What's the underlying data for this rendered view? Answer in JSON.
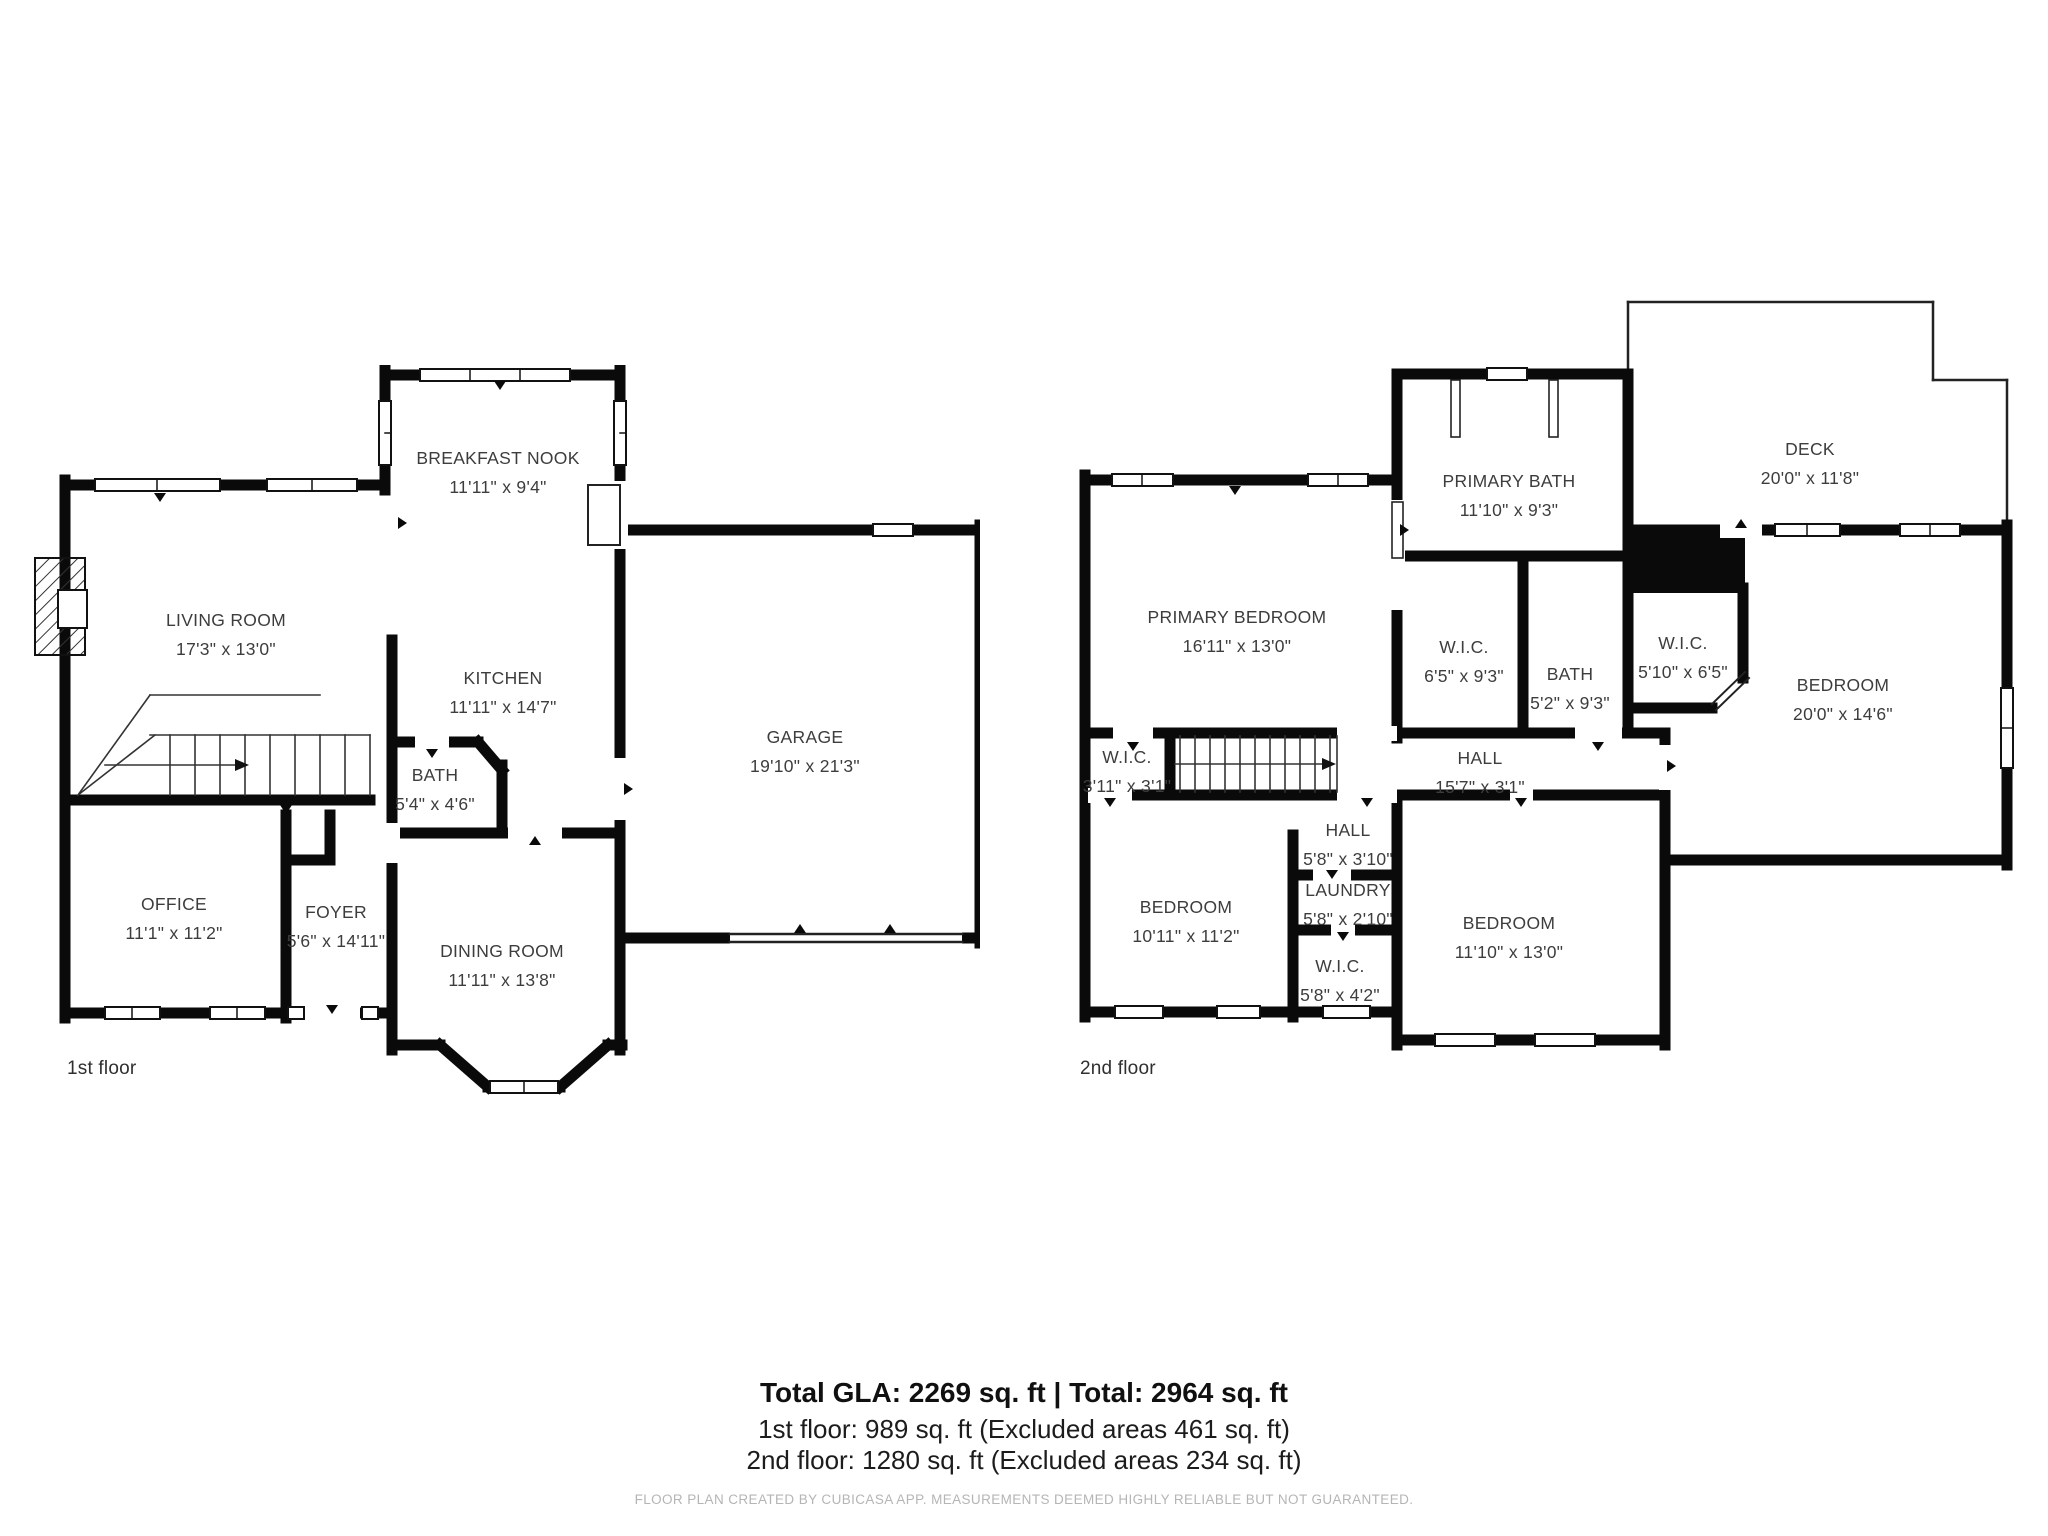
{
  "page": {
    "background": "#ffffff",
    "wall_color": "#0a0a0a",
    "label_color": "#3d3d3d",
    "footer_color": "#b5b5b5"
  },
  "floor1": {
    "caption": "1st floor",
    "rooms": {
      "breakfast_nook": {
        "name": "BREAKFAST NOOK",
        "dims": "11'11\" x 9'4\""
      },
      "living_room": {
        "name": "LIVING ROOM",
        "dims": "17'3\" x 13'0\""
      },
      "kitchen": {
        "name": "KITCHEN",
        "dims": "11'11\" x 14'7\""
      },
      "garage": {
        "name": "GARAGE",
        "dims": "19'10\" x 21'3\""
      },
      "bath": {
        "name": "BATH",
        "dims": "5'4\" x 4'6\""
      },
      "office": {
        "name": "OFFICE",
        "dims": "11'1\" x 11'2\""
      },
      "foyer": {
        "name": "FOYER",
        "dims": "5'6\" x 14'11\""
      },
      "dining_room": {
        "name": "DINING ROOM",
        "dims": "11'11\" x 13'8\""
      }
    }
  },
  "floor2": {
    "caption": "2nd floor",
    "rooms": {
      "primary_bath": {
        "name": "PRIMARY BATH",
        "dims": "11'10\" x 9'3\""
      },
      "deck": {
        "name": "DECK",
        "dims": "20'0\" x 11'8\""
      },
      "primary_bedroom": {
        "name": "PRIMARY BEDROOM",
        "dims": "16'11\" x 13'0\""
      },
      "wic_primary": {
        "name": "W.I.C.",
        "dims": "6'5\" x 9'3\""
      },
      "bath": {
        "name": "BATH",
        "dims": "5'2\" x 9'3\""
      },
      "wic_corner": {
        "name": "W.I.C.",
        "dims": "5'10\" x 6'5\""
      },
      "bedroom_right": {
        "name": "BEDROOM",
        "dims": "20'0\" x 14'6\""
      },
      "wic_hall": {
        "name": "W.I.C.",
        "dims": "3'11\" x 3'1\""
      },
      "hall": {
        "name": "HALL",
        "dims": "15'7\" x 3'1\""
      },
      "hall_small": {
        "name": "HALL",
        "dims": "5'8\" x 3'10\""
      },
      "laundry": {
        "name": "LAUNDRY",
        "dims": "5'8\" x 2'10\""
      },
      "bedroom_left": {
        "name": "BEDROOM",
        "dims": "10'11\" x 11'2\""
      },
      "wic_bottom": {
        "name": "W.I.C.",
        "dims": "5'8\" x 4'2\""
      },
      "bedroom_bottom": {
        "name": "BEDROOM",
        "dims": "11'10\" x 13'0\""
      }
    }
  },
  "summary": {
    "line1": "Total GLA: 2269 sq. ft | Total: 2964 sq. ft",
    "line2": "1st floor: 989 sq. ft (Excluded areas 461 sq. ft)",
    "line3": "2nd floor: 1280 sq. ft (Excluded areas 234 sq. ft)"
  },
  "footer": "FLOOR PLAN CREATED BY CUBICASA APP. MEASUREMENTS DEEMED HIGHLY RELIABLE BUT NOT GUARANTEED."
}
